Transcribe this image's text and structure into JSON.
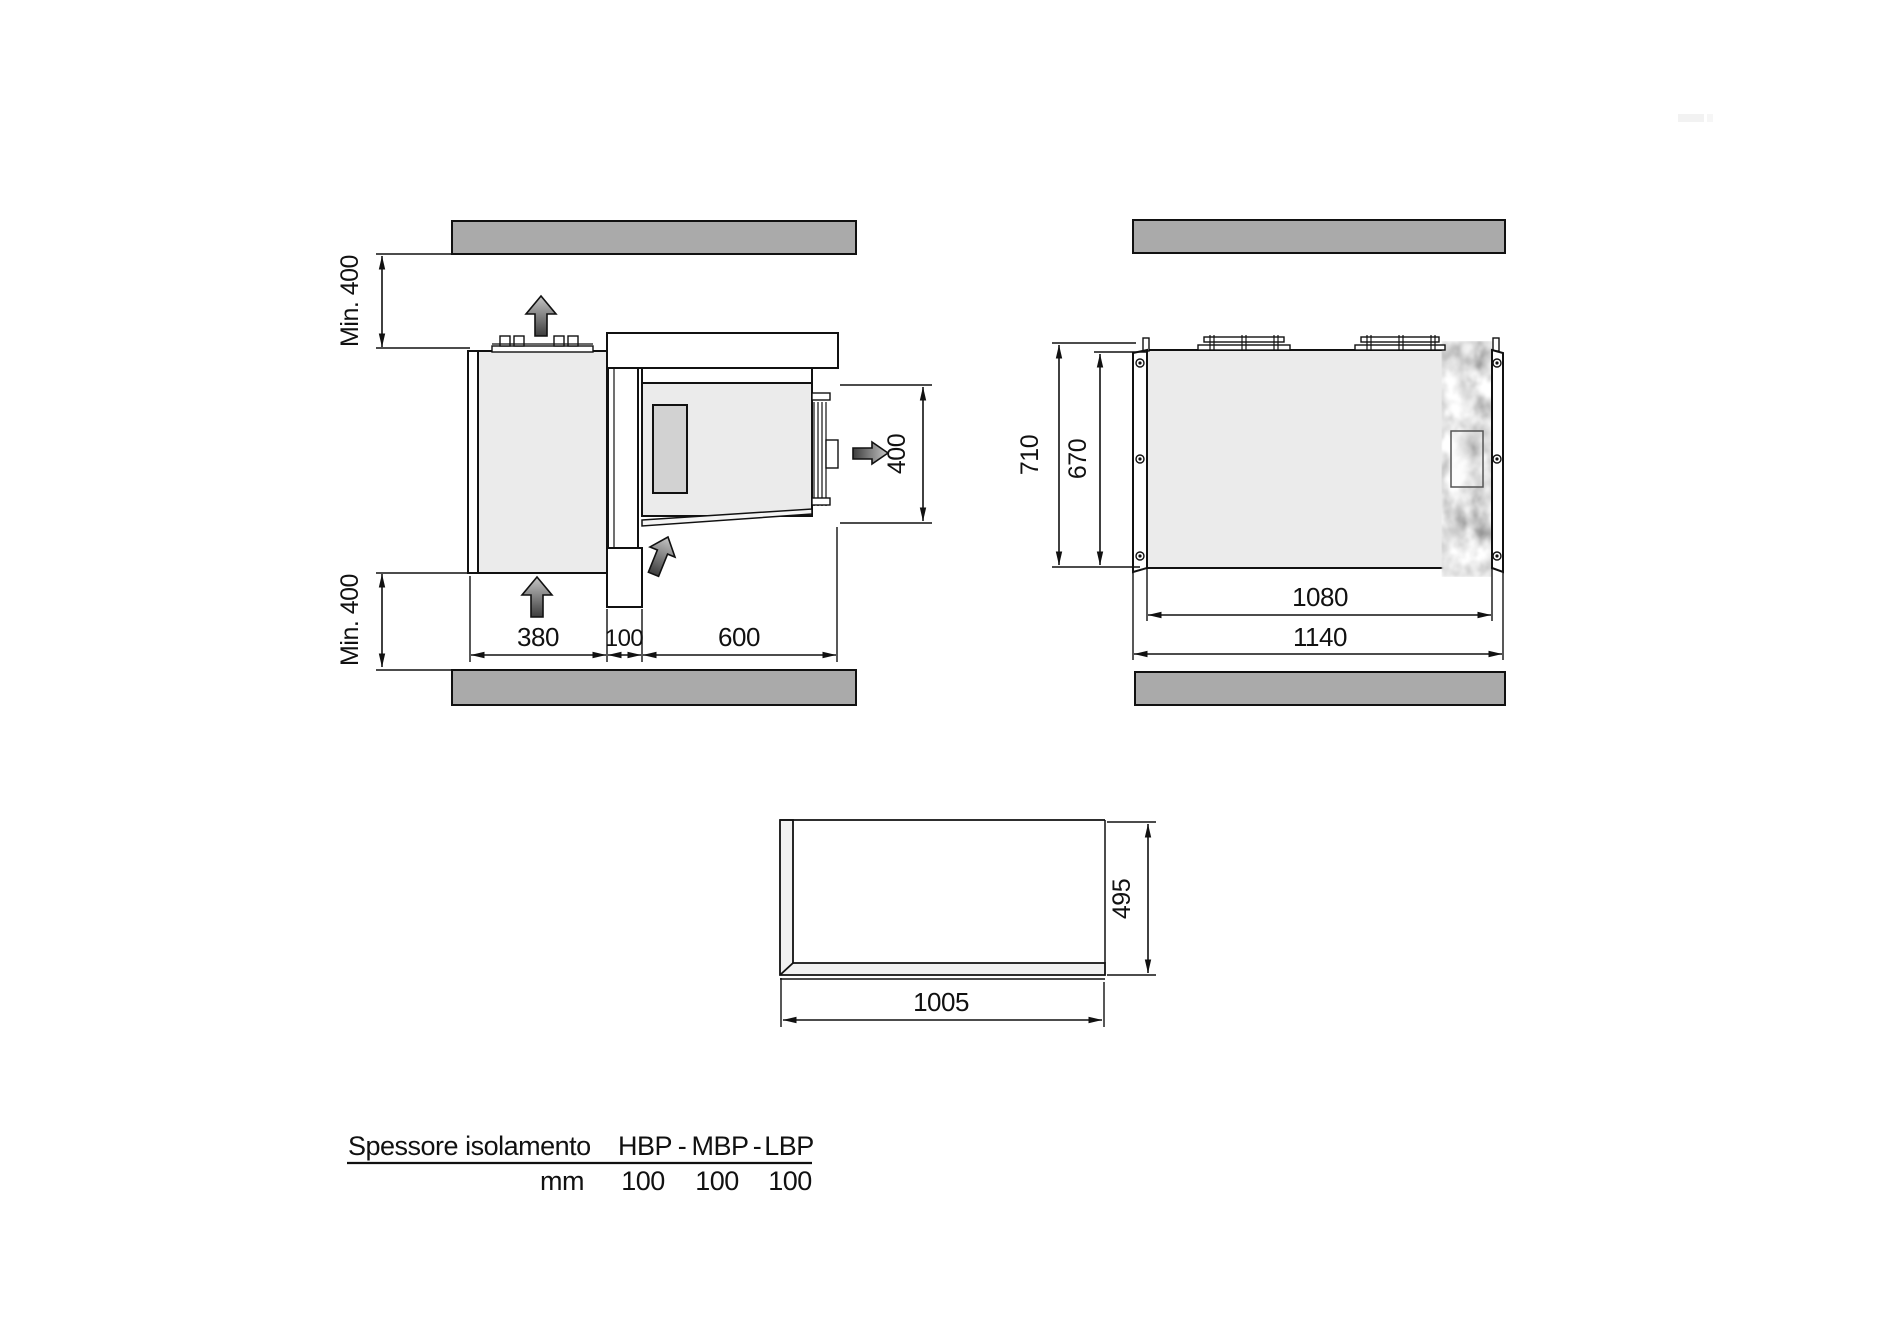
{
  "views": {
    "side_view": {
      "clearance_top": "Min. 400",
      "clearance_bottom": "Min. 400",
      "dim_condensing_depth": "380",
      "dim_wall_thickness": "100",
      "dim_evaporator_depth": "600",
      "dim_evaporator_width": "400"
    },
    "top_view": {
      "dim_depth_overall": "710",
      "dim_depth_body": "670",
      "dim_width_body": "1080",
      "dim_width_overall": "1140"
    },
    "panel_view": {
      "dim_length": "1005",
      "dim_depth": "495"
    }
  },
  "table": {
    "title": "Spessore isolamento",
    "columns": [
      "HBP",
      "MBP",
      "LBP"
    ],
    "separator": "-",
    "unit": "mm",
    "values": [
      "100",
      "100",
      "100"
    ]
  },
  "colors": {
    "wall_gray": "#aaaaaa",
    "unit_body_gray": "#ebebeb",
    "fan_panel_gray": "#d2d2d2",
    "line_black": "#111111"
  }
}
